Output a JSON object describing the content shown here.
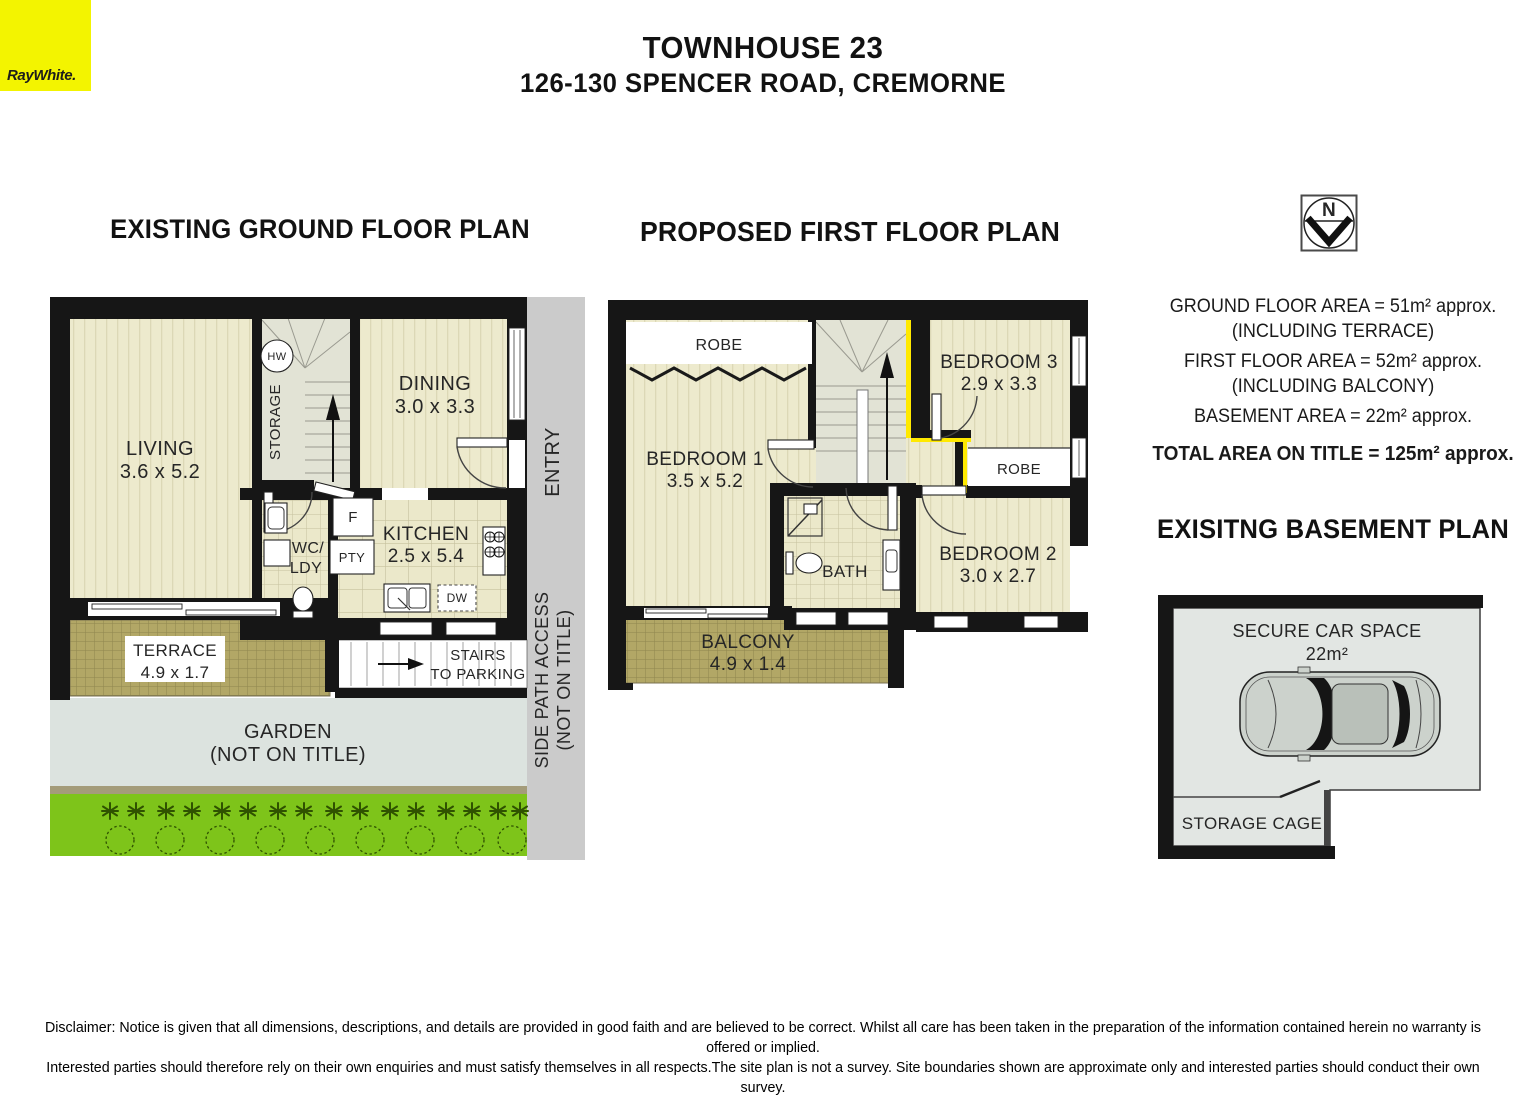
{
  "brand": {
    "logo": "RayWhite.",
    "color": "#f3f400"
  },
  "header": {
    "title": "TOWNHOUSE 23",
    "subtitle": "126-130 SPENCER ROAD, CREMORNE"
  },
  "north": {
    "letter": "N"
  },
  "ground": {
    "heading": "EXISTING GROUND FLOOR PLAN",
    "living_name": "LIVING",
    "living_dims": "3.6 x 5.2",
    "dining_name": "DINING",
    "dining_dims": "3.0 x 3.3",
    "kitchen_name": "KITCHEN",
    "kitchen_dims": "2.5 x 5.4",
    "wc_line1": "WC/",
    "wc_line2": "LDY",
    "storage": "STORAGE",
    "hw": "HW",
    "fridge": "F",
    "pantry": "PTY",
    "dishwasher": "DW",
    "terrace_name": "TERRACE",
    "terrace_dims": "4.9 x 1.7",
    "stairs_line1": "STAIRS",
    "stairs_line2": "TO PARKING",
    "garden_line1": "GARDEN",
    "garden_line2": "(NOT ON TITLE)",
    "entry": "ENTRY",
    "sidepath_line1": "SIDE PATH ACCESS",
    "sidepath_line2": "(NOT ON TITLE)"
  },
  "first": {
    "heading": "PROPOSED FIRST FLOOR PLAN",
    "bed1_name": "BEDROOM 1",
    "bed1_dims": "3.5 x 5.2",
    "bed2_name": "BEDROOM 2",
    "bed2_dims": "3.0 x 2.7",
    "bed3_name": "BEDROOM 3",
    "bed3_dims": "2.9 x 3.3",
    "robe_top": "ROBE",
    "robe_right": "ROBE",
    "bath": "BATH",
    "balcony_name": "BALCONY",
    "balcony_dims": "4.9 x 1.4"
  },
  "basement": {
    "heading": "EXISITNG BASEMENT PLAN",
    "car_line1": "SECURE CAR SPACE",
    "car_line2": "22m²",
    "storage_cage": "STORAGE CAGE"
  },
  "areas": {
    "ground": "GROUND FLOOR AREA = 51m² approx.",
    "ground_note": "(INCLUDING TERRACE)",
    "first": "FIRST FLOOR AREA = 52m² approx.",
    "first_note": "(INCLUDING BALCONY)",
    "basement": "BASEMENT AREA = 22m² approx.",
    "total": "TOTAL AREA ON TITLE = 125m² approx."
  },
  "disclaimer": {
    "line1": "Disclaimer: Notice is given that all dimensions, descriptions, and details are provided in good faith and are believed to be correct. Whilst all care has been taken in the preparation of the information contained herein no warranty is offered or implied.",
    "line2": "Interested parties should therefore rely on their own enquiries and must satisfy themselves in all respects.The site plan is not a survey. Site boundaries shown are approximate only and interested parties should conduct their own survey."
  },
  "colors": {
    "brand_yellow": "#f3f400",
    "highlight_yellow": "#ffe900",
    "floor_cream": "#edeacd",
    "tile_khaki": "#b2a766",
    "garden_grass": "#7ec41a",
    "garden_bed": "#dce3df",
    "path_gray": "#cbcbcb",
    "wall_black": "#161616"
  }
}
